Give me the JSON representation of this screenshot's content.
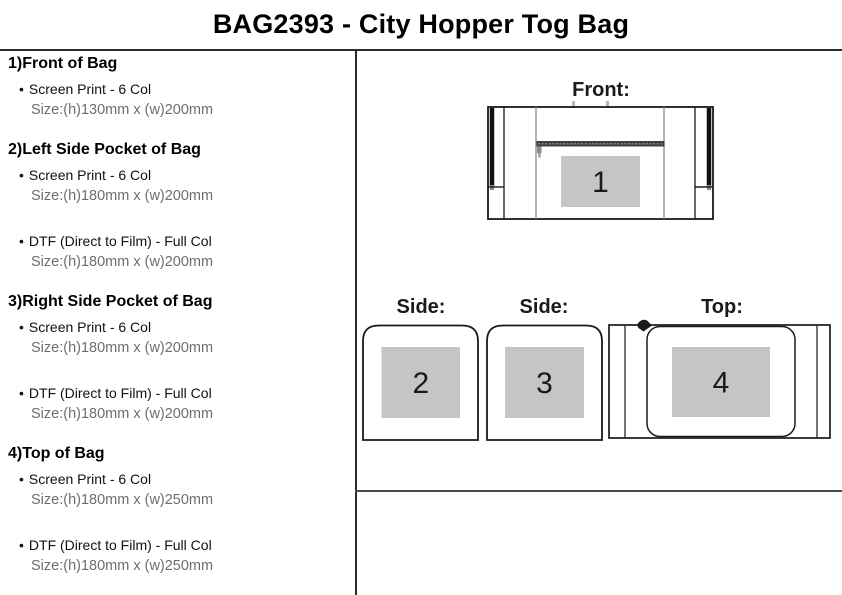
{
  "title": "BAG2393 - City Hopper Tog Bag",
  "sections": [
    {
      "heading": "1)Front of Bag",
      "options": [
        {
          "method": "Screen Print - 6 Col",
          "size": "Size:(h)130mm x (w)200mm"
        }
      ]
    },
    {
      "heading": "2)Left Side Pocket of Bag",
      "options": [
        {
          "method": "Screen Print - 6 Col",
          "size": "Size:(h)180mm x (w)200mm"
        },
        {
          "method": "DTF (Direct to Film) - Full Col",
          "size": "Size:(h)180mm x (w)200mm"
        }
      ]
    },
    {
      "heading": "3)Right Side Pocket of Bag",
      "options": [
        {
          "method": "Screen Print - 6 Col",
          "size": "Size:(h)180mm x (w)200mm"
        },
        {
          "method": "DTF (Direct to Film) - Full Col",
          "size": "Size:(h)180mm x (w)200mm"
        }
      ]
    },
    {
      "heading": "4)Top of Bag",
      "options": [
        {
          "method": "Screen Print - 6 Col",
          "size": "Size:(h)180mm x (w)250mm"
        },
        {
          "method": "DTF (Direct to Film) - Full Col",
          "size": "Size:(h)180mm x (w)250mm"
        }
      ]
    }
  ],
  "diagrams": {
    "front": {
      "label": "Front:",
      "area_number": "1"
    },
    "side_left": {
      "label": "Side:",
      "area_number": "2"
    },
    "side_right": {
      "label": "Side:",
      "area_number": "3"
    },
    "top": {
      "label": "Top:",
      "area_number": "4"
    }
  },
  "colors": {
    "print_area_fill": "#c5c5c5",
    "outline": "#1a1a1a",
    "rule_line": "#2b2b2b"
  }
}
